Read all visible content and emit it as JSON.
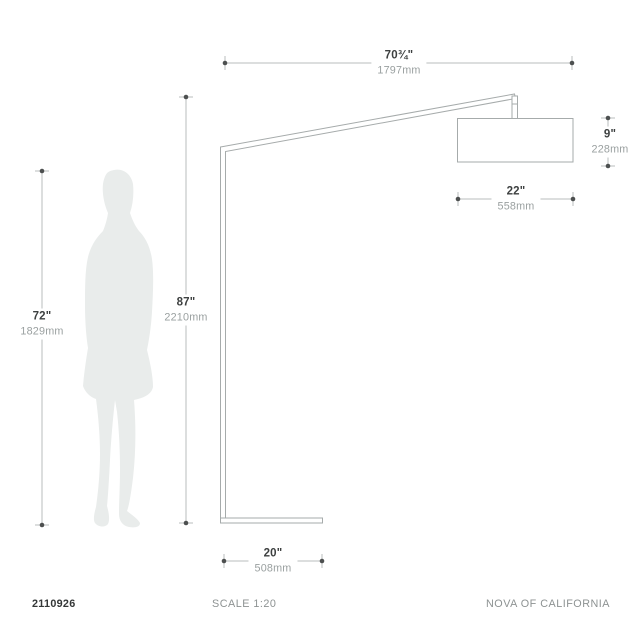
{
  "dimensions": {
    "arm_span": {
      "inches": "70¾\"",
      "mm": "1797mm"
    },
    "lamp_height": {
      "inches": "87\"",
      "mm": "2210mm"
    },
    "person_height": {
      "inches": "72\"",
      "mm": "1829mm"
    },
    "shade_height": {
      "inches": "9\"",
      "mm": "228mm"
    },
    "shade_width": {
      "inches": "22\"",
      "mm": "558mm"
    },
    "base_length": {
      "inches": "20\"",
      "mm": "508mm"
    }
  },
  "footer": {
    "item_number": "2110926",
    "scale": "SCALE 1:20",
    "brand": "NOVA OF CALIFORNIA"
  },
  "colors": {
    "background": "#ffffff",
    "dimension_line": "#b9bdbd",
    "dimension_dot": "#4d5050",
    "drawing_line": "#a6abab",
    "value_text": "#3d4040",
    "metric_text": "#9aa0a0",
    "silhouette_fill": "#e9eceb"
  }
}
